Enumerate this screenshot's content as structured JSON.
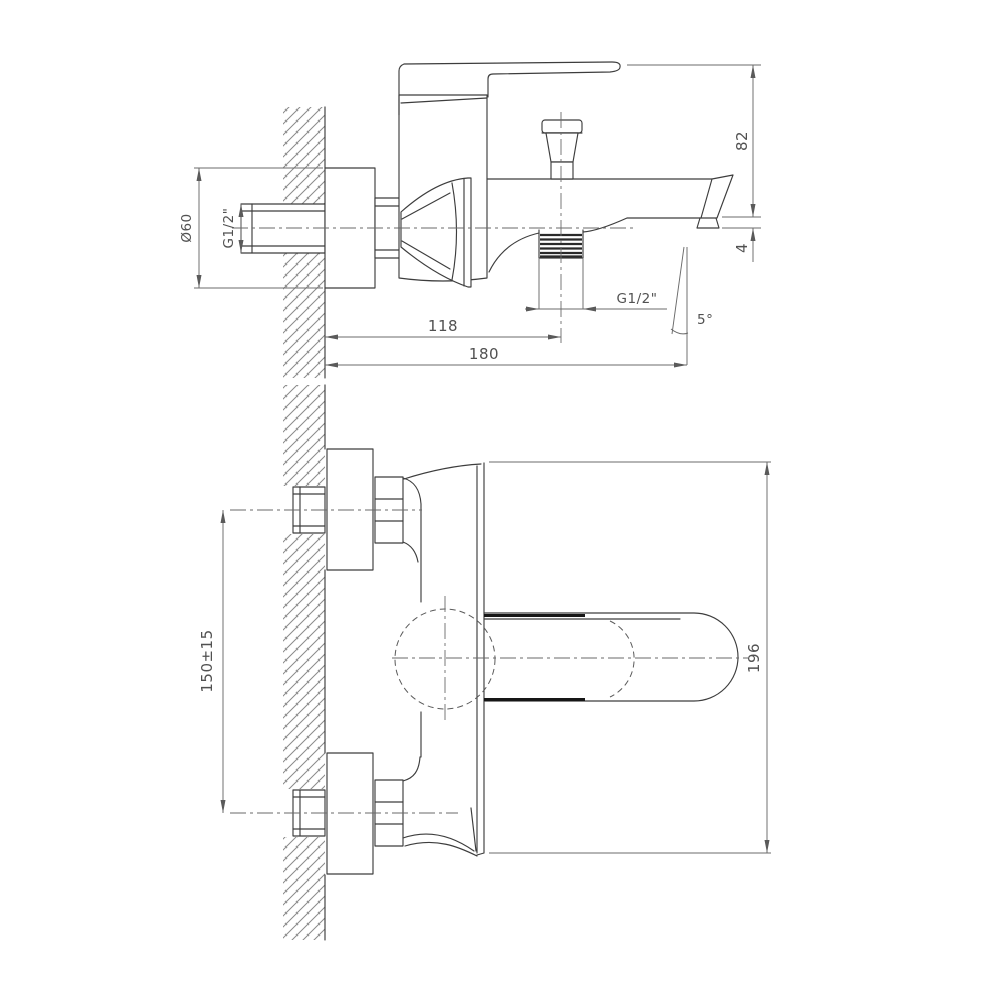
{
  "drawing": {
    "kind": "two-view dimensioned technical line drawing of a wall-mounted single-lever bath mixer tap with diverter and tub spout",
    "background_color": "#ffffff",
    "line_color": "#3d3d3d",
    "dimension_color": "#6b6b6b",
    "text_color": "#515151",
    "hatch_color": "#8a8a8a",
    "dimensions": {
      "top": {
        "diameter": "Ø60",
        "inlet_thread": "G1/2\"",
        "height": "82",
        "tip_drop": "4",
        "shower_outlet_offset": "118",
        "reach": "180",
        "outlet_thread": "G1/2\"",
        "angle": "5°"
      },
      "bottom": {
        "inlet_spacing": "150±15",
        "overall_height": "196"
      }
    }
  }
}
